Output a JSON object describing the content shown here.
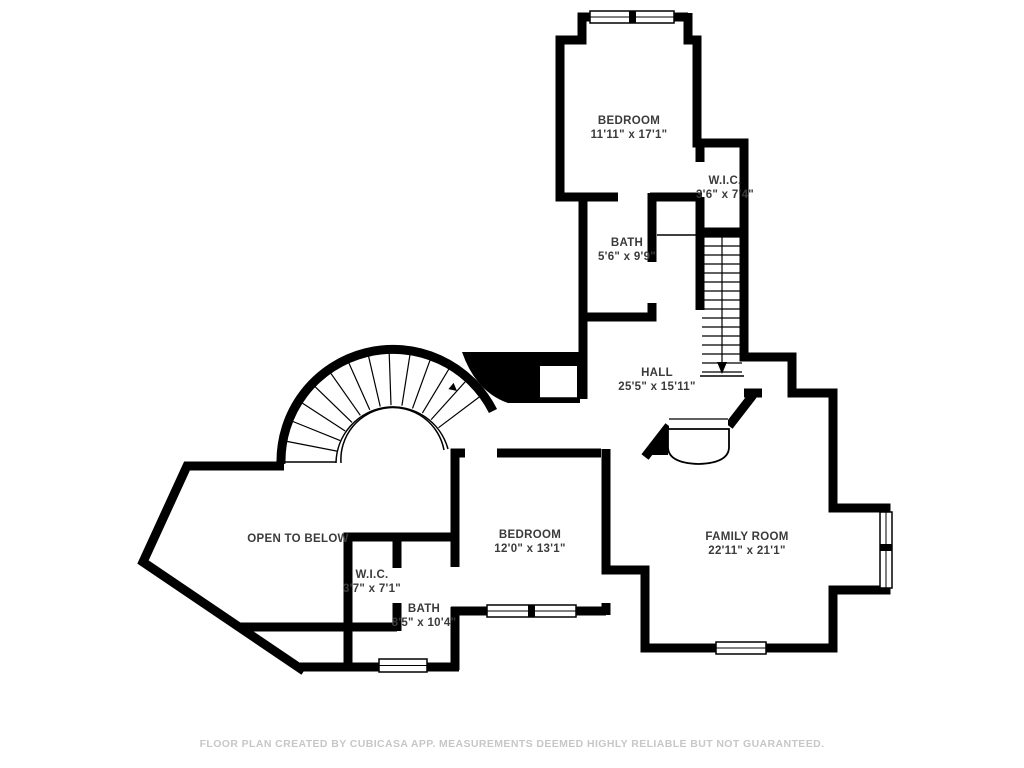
{
  "colors": {
    "wall": "#000000",
    "label": "#3b3b3b",
    "footer": "#c7c7c7",
    "background": "#ffffff"
  },
  "rooms": [
    {
      "name": "BEDROOM",
      "dims": "11'11\" x 17'1\""
    },
    {
      "name": "W.I.C.",
      "dims": "3'6\" x 7'4\""
    },
    {
      "name": "BATH",
      "dims": "5'6\" x 9'9\""
    },
    {
      "name": "HALL",
      "dims": "25'5\" x 15'11\""
    },
    {
      "name": "OPEN TO BELOW",
      "dims": ""
    },
    {
      "name": "W.I.C.",
      "dims": "3'7\" x 7'1\""
    },
    {
      "name": "BATH",
      "dims": "8'5\" x 10'4\""
    },
    {
      "name": "BEDROOM",
      "dims": "12'0\" x 13'1\""
    },
    {
      "name": "FAMILY ROOM",
      "dims": "22'11\" x 21'1\""
    }
  ],
  "footer": "FLOOR PLAN CREATED BY CUBICASA APP. MEASUREMENTS DEEMED HIGHLY RELIABLE BUT NOT GUARANTEED."
}
